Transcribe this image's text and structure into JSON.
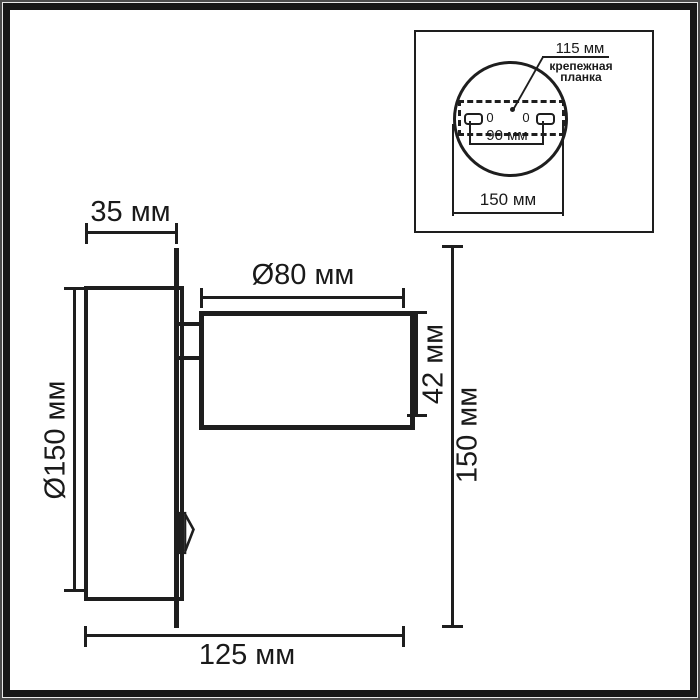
{
  "colors": {
    "line": "#1e1e1e",
    "text": "#1a1a1a",
    "background": "#ffffff"
  },
  "main_view": {
    "base_depth": "35 мм",
    "head_diameter": "Ø80 мм",
    "head_height": "42 мм",
    "base_diameter": "Ø150 мм",
    "overall_height": "150 мм",
    "overall_depth": "125 мм"
  },
  "inset": {
    "plate_width": "115 мм",
    "plate_label_line1": "крепежная",
    "plate_label_line2": "планка",
    "hole_spacing": "90 мм",
    "backplate_diameter": "150 мм",
    "hole_mark_left": "0",
    "hole_mark_right": "0"
  }
}
